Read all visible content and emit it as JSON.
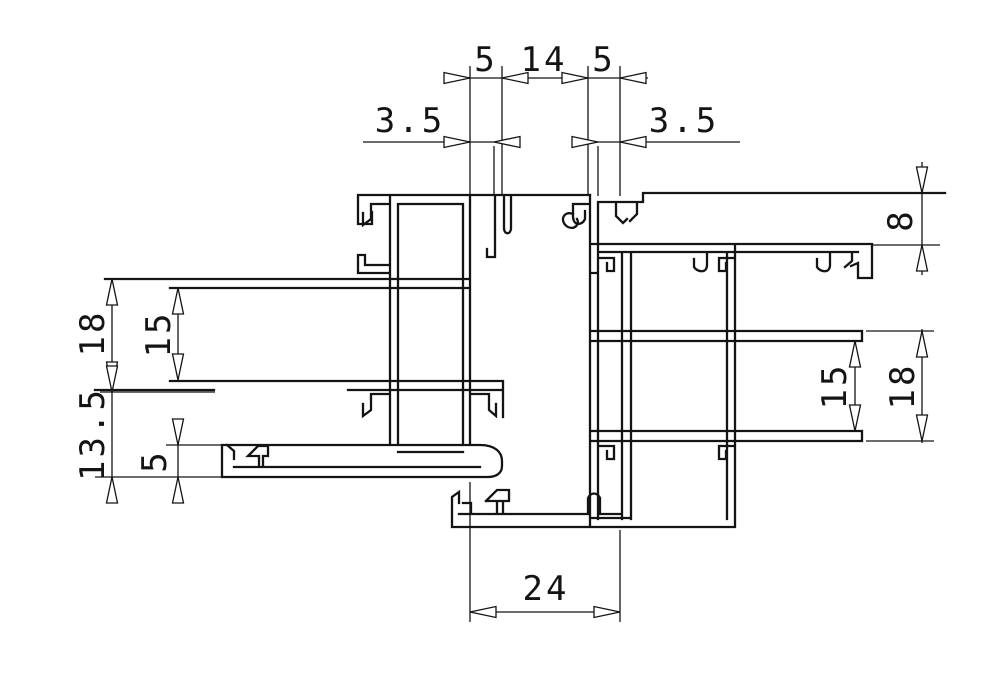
{
  "drawing": {
    "type": "technical-drawing",
    "subject": "aluminum extrusion profile cross-section (two interlocking frame profiles)",
    "background_color": "#ffffff",
    "line_color": "#141414"
  },
  "dims": {
    "top": {
      "slot_left": "5",
      "span_center": "14",
      "slot_right": "5",
      "wall_left": "3.5",
      "wall_right": "3.5"
    },
    "left": {
      "depth_outer": "18",
      "depth_inner": "15",
      "lower_depth": "13.5",
      "channel_height": "5"
    },
    "right": {
      "top_height": "8",
      "depth_inner": "15",
      "depth_outer": "18"
    },
    "bottom": {
      "track_width": "24"
    }
  }
}
